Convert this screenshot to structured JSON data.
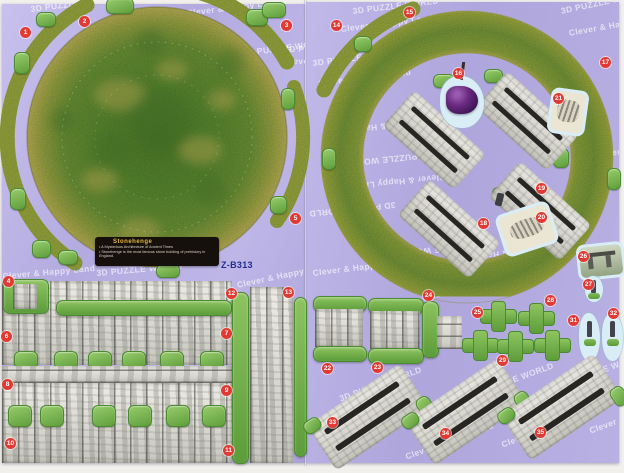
{
  "label_box": {
    "title": "Stonehenge",
    "bullet1": "• A Mysterious Architecture of Ancient Times",
    "bullet2": "• Stonehenge is the most famous stone building of prehistory in England."
  },
  "model_code": "Z-B313",
  "watermark": {
    "line1": "3D PUZZLE WORLD",
    "line2": "Clever & Happy Land",
    "tiles": [
      {
        "s": "L",
        "x": 28,
        "y": 0,
        "t": 1,
        "r": -7
      },
      {
        "s": "L",
        "x": 184,
        "y": 4,
        "t": 2,
        "r": -7
      },
      {
        "s": "L",
        "x": 240,
        "y": 44,
        "t": 1,
        "r": -7
      },
      {
        "s": "L",
        "x": 282,
        "y": 40,
        "t": 1,
        "r": 0
      },
      {
        "s": "L",
        "x": 282,
        "y": 52,
        "t": 2,
        "r": 0
      },
      {
        "s": "L",
        "x": 0,
        "y": 267,
        "t": 2,
        "r": -5
      },
      {
        "s": "L",
        "x": 94,
        "y": 264,
        "t": 1,
        "r": -5
      },
      {
        "s": "L",
        "x": 234,
        "y": 276,
        "t": 2,
        "r": -12
      },
      {
        "s": "R",
        "x": 46,
        "y": 4,
        "t": 1,
        "r": -7
      },
      {
        "s": "R",
        "x": 34,
        "y": 22,
        "t": 2,
        "r": -7
      },
      {
        "s": "R",
        "x": 6,
        "y": 56,
        "t": 1,
        "r": -7
      },
      {
        "s": "R",
        "x": 12,
        "y": 76,
        "t": 2,
        "r": -7
      },
      {
        "s": "R",
        "x": 254,
        "y": 4,
        "t": 1,
        "r": -12
      },
      {
        "s": "R",
        "x": 262,
        "y": 26,
        "t": 2,
        "r": -10
      },
      {
        "s": "R",
        "x": 286,
        "y": 148,
        "t": 2,
        "r": -7
      },
      {
        "s": "R",
        "x": 126,
        "y": 158,
        "t": 1,
        "r": 174
      },
      {
        "s": "R",
        "x": 140,
        "y": 180,
        "t": 2,
        "r": 174
      },
      {
        "s": "R",
        "x": 112,
        "y": 126,
        "t": 2,
        "r": 174
      },
      {
        "s": "R",
        "x": 90,
        "y": 208,
        "t": 1,
        "r": 174
      },
      {
        "s": "R",
        "x": 6,
        "y": 266,
        "t": 2,
        "r": -7
      },
      {
        "s": "R",
        "x": 124,
        "y": 288,
        "t": 1,
        "r": -7
      },
      {
        "s": "R",
        "x": 32,
        "y": 392,
        "t": 1,
        "r": -20
      },
      {
        "s": "R",
        "x": 164,
        "y": 388,
        "t": 1,
        "r": -20
      },
      {
        "s": "R",
        "x": 254,
        "y": 378,
        "t": 1,
        "r": -20
      },
      {
        "s": "R",
        "x": 98,
        "y": 450,
        "t": 2,
        "r": -20
      },
      {
        "s": "R",
        "x": 194,
        "y": 438,
        "t": 2,
        "r": -20
      },
      {
        "s": "R",
        "x": 282,
        "y": 424,
        "t": 2,
        "r": -20
      },
      {
        "s": "R",
        "x": 234,
        "y": 253,
        "t": 2,
        "r": 174
      },
      {
        "s": "R",
        "x": 178,
        "y": 248,
        "t": 1,
        "r": 174
      }
    ]
  },
  "badges": [
    {
      "n": "1",
      "x": 25,
      "y": 32
    },
    {
      "n": "2",
      "x": 84,
      "y": 21
    },
    {
      "n": "3",
      "x": 286,
      "y": 25
    },
    {
      "n": "4",
      "x": 8,
      "y": 281
    },
    {
      "n": "5",
      "x": 295,
      "y": 218
    },
    {
      "n": "6",
      "x": 6,
      "y": 336
    },
    {
      "n": "7",
      "x": 226,
      "y": 333
    },
    {
      "n": "8",
      "x": 7,
      "y": 384
    },
    {
      "n": "9",
      "x": 226,
      "y": 390
    },
    {
      "n": "10",
      "x": 10,
      "y": 443
    },
    {
      "n": "11",
      "x": 228,
      "y": 450
    },
    {
      "n": "12",
      "x": 231,
      "y": 293
    },
    {
      "n": "13",
      "x": 288,
      "y": 292
    },
    {
      "n": "14",
      "x": 336,
      "y": 25
    },
    {
      "n": "15",
      "x": 409,
      "y": 12
    },
    {
      "n": "16",
      "x": 458,
      "y": 73
    },
    {
      "n": "17",
      "x": 605,
      "y": 62
    },
    {
      "n": "18",
      "x": 483,
      "y": 223
    },
    {
      "n": "19",
      "x": 541,
      "y": 188
    },
    {
      "n": "20",
      "x": 541,
      "y": 217
    },
    {
      "n": "21",
      "x": 558,
      "y": 98
    },
    {
      "n": "22",
      "x": 327,
      "y": 368
    },
    {
      "n": "23",
      "x": 377,
      "y": 367
    },
    {
      "n": "24",
      "x": 428,
      "y": 295
    },
    {
      "n": "25",
      "x": 477,
      "y": 312
    },
    {
      "n": "26",
      "x": 583,
      "y": 256
    },
    {
      "n": "27",
      "x": 588,
      "y": 284
    },
    {
      "n": "28",
      "x": 550,
      "y": 300
    },
    {
      "n": "29",
      "x": 502,
      "y": 360
    },
    {
      "n": "31",
      "x": 573,
      "y": 320
    },
    {
      "n": "32",
      "x": 613,
      "y": 313
    },
    {
      "n": "33",
      "x": 332,
      "y": 422
    },
    {
      "n": "34",
      "x": 445,
      "y": 433
    },
    {
      "n": "35",
      "x": 540,
      "y": 432
    }
  ],
  "colors": {
    "sheet_lavender": "#b3abdf",
    "grass_green": "#5c8a33",
    "grass_olive": "#a9ad4a",
    "tab_green": "#6fae44",
    "badge_red": "#e23a33",
    "label_gold": "#e7b644",
    "code_blue": "#232d8f",
    "stone_light": "#e4e3dd",
    "halo_blue": "#d9edf7",
    "heelstone_purple": "#56217a"
  }
}
